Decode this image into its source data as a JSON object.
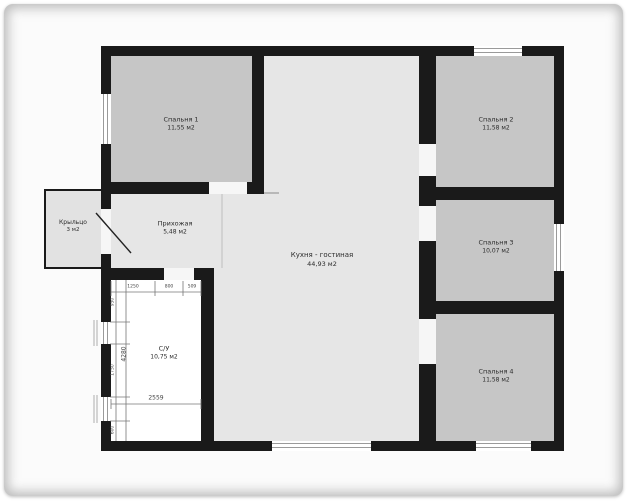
{
  "plan_title": "house-floor-plan",
  "rooms": [
    {
      "id": "bedroom1",
      "name": "Спальня 1",
      "area": "11,55 м2"
    },
    {
      "id": "bedroom2",
      "name": "Спальня 2",
      "area": "11,58 м2"
    },
    {
      "id": "bedroom3",
      "name": "Спальня 3",
      "area": "10,07 м2"
    },
    {
      "id": "bedroom4",
      "name": "Спальня 4",
      "area": "11,58 м2"
    },
    {
      "id": "kitchen_living",
      "name": "Кухня - гостиная",
      "area": "44,93 м2"
    },
    {
      "id": "hallway",
      "name": "Прихожая",
      "area": "5,48 м2"
    },
    {
      "id": "bathroom",
      "name": "С/У",
      "area": "10,75 м2"
    },
    {
      "id": "porch",
      "name": "Крыльцо",
      "area": "3 м2"
    }
  ],
  "dimensions": {
    "chain_top": [
      "1250",
      "800",
      "509"
    ],
    "overall_width": "2559",
    "overall_height": "4280",
    "chain_left": [
      "950",
      "1750",
      "600"
    ]
  },
  "colors": {
    "wall": "#1a1a1a",
    "bedroom_fill": "#c6c6c6",
    "kitchen_fill": "#e6e6e6",
    "bathroom_fill": "#ffffff",
    "porch_fill": "#e2e2e2",
    "page": "#fbfbfb"
  }
}
